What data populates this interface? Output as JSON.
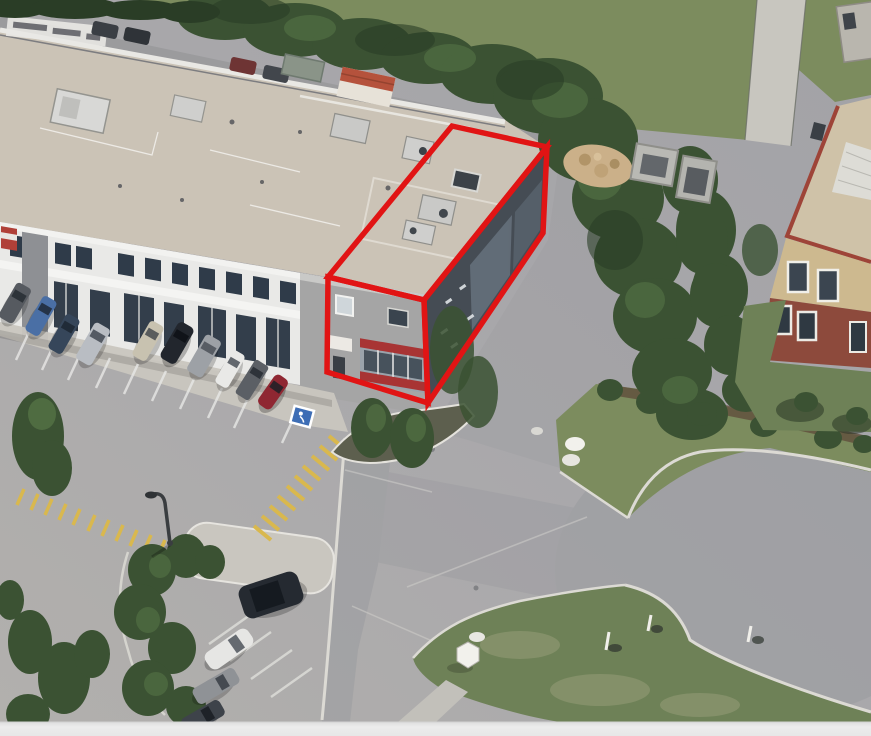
{
  "scene": {
    "type": "oblique-aerial-3d-view",
    "description": "Aerial 3D satellite view of a two-storey commercial plaza; the end unit is highlighted with a red 3D wireframe box. Parking lot with parked cars in front, yellow hatched pedestrian markings, a cul-de-sac with grass islands at right, dense trees behind, and a neighbouring brick building at far right.",
    "annotated_feature": "highlighted-end-unit"
  },
  "palette": {
    "pavement": "#a9a8ab",
    "road_shade": "#97989c",
    "roof": "#cbc3b6",
    "roof_right": "#cfc2a8",
    "parapet_red": "#9e4438",
    "facade_white": "#e9e9e7",
    "facade_gray": "#8e9094",
    "unit_front": "#a5a5a5",
    "end_wall": "#454c54",
    "walkway": "#c9c6bf",
    "curb_white": "#dcdad4",
    "grass": "#7c8c5e",
    "grass_dark": "#6e8157",
    "tree_green": "#3b5233",
    "tree_light": "#587747",
    "tree_dark": "#2a3d26",
    "hedge_brown": "#5d4a3a",
    "yellow_marking": "#d9b84e",
    "brick": "#8d4a3c",
    "tan_wall": "#cdb98f",
    "path_gray": "#c8c6bf",
    "handicap_blue": "#3d6db5",
    "white_object": "#f2f1ec"
  },
  "annotation": {
    "shape": "3d-box-wireframe",
    "color": "#e11414",
    "top_face_points": "452,126 547,147 424,300 328,277",
    "front_face_points": "328,277 327,372 428,403 424,300",
    "right_face_points": "424,300 428,403 543,233 547,147"
  },
  "vehicles": {
    "front_row": [
      {
        "type": "van",
        "color": "#565a60"
      },
      {
        "type": "sedan",
        "color": "#4a6fa5"
      },
      {
        "type": "sedan",
        "color": "#36465a"
      },
      {
        "type": "van",
        "color": "#b9bdc3"
      },
      {
        "type": "sedan",
        "color": "#c8c2b0"
      },
      {
        "type": "suv",
        "color": "#22262d"
      },
      {
        "type": "van",
        "color": "#9da1a6"
      },
      {
        "type": "sedan",
        "color": "#e9e9e7"
      },
      {
        "type": "pickup",
        "color": "#5b5f65"
      },
      {
        "type": "hatchback",
        "color": "#8f2732"
      }
    ],
    "lower_rows": [
      {
        "type": "suv",
        "color": "#252a31"
      },
      {
        "type": "suv",
        "color": "#e6e6e4"
      },
      {
        "type": "sedan",
        "color": "#8f9296"
      },
      {
        "type": "sedan",
        "color": "#3e434a"
      }
    ],
    "back_lane": [
      {
        "type": "car",
        "color": "#3a3e44"
      },
      {
        "type": "car",
        "color": "#2f3338"
      },
      {
        "type": "car",
        "color": "#6e3434"
      },
      {
        "type": "car",
        "color": "#42464c"
      }
    ]
  },
  "markings": {
    "handicap_stall_color": "#3d6db5",
    "yellow_hatch_band_count": 2
  },
  "ui": {
    "bottom_bar_color": "#ebebeb"
  }
}
